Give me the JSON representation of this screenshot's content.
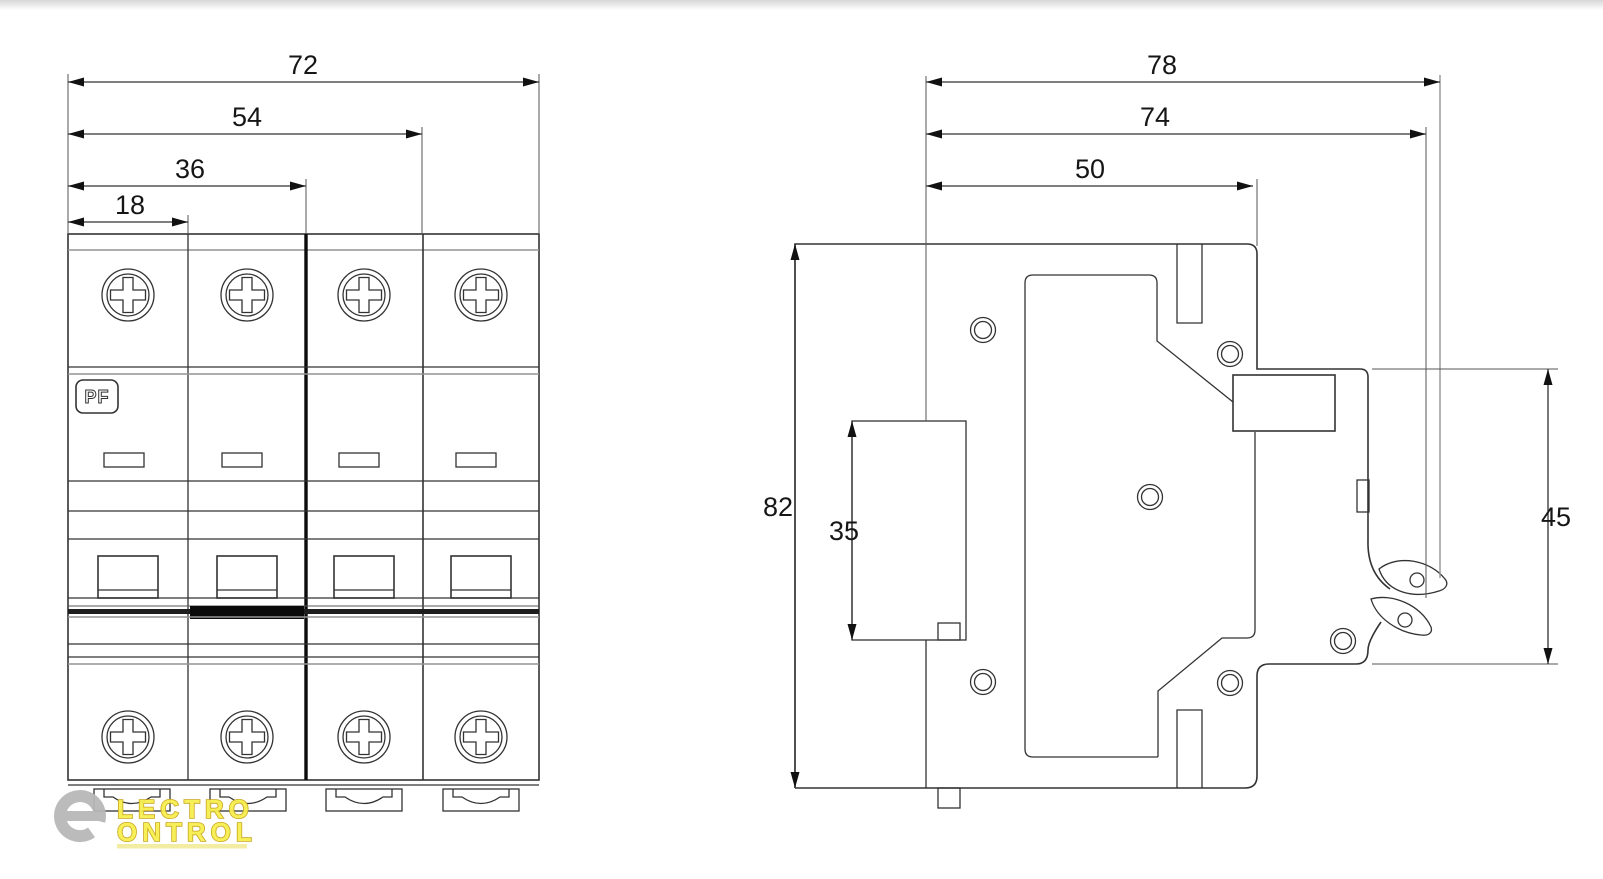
{
  "front_view": {
    "pf_label": "PF",
    "dim_total_width": "72",
    "dim_three_modules": "54",
    "dim_two_modules": "36",
    "dim_one_module": "18"
  },
  "side_view": {
    "dim_depth_total": "78",
    "dim_depth_to_clip": "74",
    "dim_depth_front": "50",
    "dim_height": "82",
    "dim_din_rail": "35",
    "dim_front_section_height": "45"
  },
  "watermark": {
    "line1": "LECTRO",
    "line2": "ONTROL",
    "text_fill": "#f7ef50",
    "text_outline": "#c7a112",
    "underline_color": "#f3eda0",
    "symbol_color": "#b8b8b8"
  },
  "colors": {
    "background": "#ffffff",
    "line_main": "#333333",
    "line_secondary": "#949494"
  }
}
